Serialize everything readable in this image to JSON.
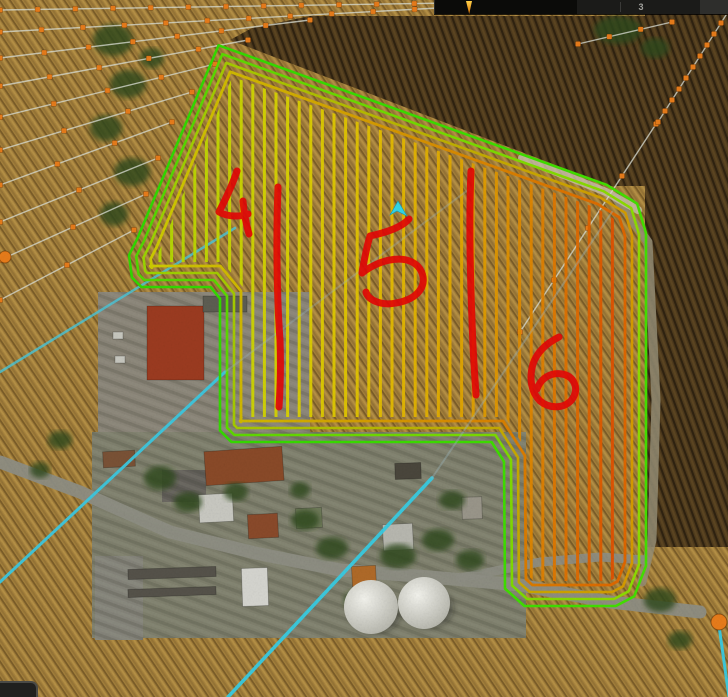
{
  "hud": {
    "count_label": "3"
  },
  "map": {
    "colors": {
      "stubble": "#a5813c",
      "stubble_dark": "#5e4a22",
      "stubble_light": "#c8a055",
      "plow": "#4e3a1c",
      "plow_dark": "#2e2210",
      "village": "#7f806d",
      "yard": "#8a8578",
      "road": "#8e8e84",
      "gravel": "#958e76",
      "gravel_light": "#c9c2ae",
      "waypoint": "#e87c1a",
      "ad_line": "#d9ddd3",
      "cyan": "#38cce4",
      "cyan_faint": "#9fb8c0",
      "red": "#e60505",
      "player": "#35d7e8"
    },
    "field": {
      "boundary": [
        [
          218,
          44
        ],
        [
          607,
          184
        ],
        [
          638,
          203
        ],
        [
          647,
          233
        ],
        [
          647,
          566
        ],
        [
          635,
          597
        ],
        [
          616,
          607
        ],
        [
          524,
          607
        ],
        [
          504,
          589
        ],
        [
          503,
          462
        ],
        [
          491,
          443
        ],
        [
          231,
          443
        ],
        [
          219,
          431
        ],
        [
          219,
          299
        ],
        [
          210,
          288
        ],
        [
          141,
          288
        ],
        [
          131,
          278
        ],
        [
          128,
          255
        ],
        [
          137,
          237
        ]
      ],
      "headlands": {
        "insets": [
          1,
          8,
          15,
          22
        ],
        "widths": [
          2.6,
          2.6,
          2.6,
          2.8
        ],
        "gradients": [
          [
            "#30d800",
            "#44e000"
          ],
          [
            "#50d800",
            "#90dc00"
          ],
          [
            "#98d800",
            "#d89800"
          ],
          [
            "#ccd200",
            "#e06000"
          ]
        ]
      },
      "rows": {
        "x_start": 160,
        "x_end": 643,
        "step": 11.6,
        "width": 3,
        "clip_inset": 26,
        "color_stops": [
          [
            160,
            "#b4dc00"
          ],
          [
            290,
            "#dcd400"
          ],
          [
            380,
            "#e6c000"
          ],
          [
            470,
            "#e2a400"
          ],
          [
            540,
            "#e08200"
          ],
          [
            600,
            "#e05c00"
          ],
          [
            643,
            "#e63c00"
          ]
        ]
      }
    },
    "red_marks": [
      {
        "label": "4",
        "paths": [
          "M237,171 C231,189 224,202 219,212 C228,217 240,217 248,214",
          "M243,201 C244,213 246,224 249,234"
        ]
      },
      {
        "label": "divider-4-5",
        "paths": [
          "M278,187 C276,240 277,300 280,340 C281,368 280,392 279,407"
        ]
      },
      {
        "label": "5",
        "paths": [
          "M409,219 C401,228 384,233 370,236 C366,249 364,261 362,273",
          "M362,273 C381,258 409,253 420,269 C429,284 419,299 396,303 C381,306 368,300 366,292"
        ]
      },
      {
        "label": "divider-5-6",
        "paths": [
          "M471,171 C469,215 470,270 472,320 C473,355 475,378 476,395"
        ]
      },
      {
        "label": "6",
        "paths": [
          "M559,337 C547,343 537,352 533,364 C529,378 531,392 540,401 C551,410 567,408 573,398 C579,388 574,376 562,374 C551,372 541,378 537,389"
        ]
      }
    ],
    "player_arrow": [
      [
        398,
        201
      ],
      [
        407,
        216
      ],
      [
        397,
        211
      ],
      [
        390,
        215
      ]
    ],
    "ad_lines": [
      [
        0,
        10,
        452,
        3,
        13
      ],
      [
        0,
        32,
        456,
        7,
        12
      ],
      [
        0,
        58,
        310,
        20,
        8
      ],
      [
        0,
        86,
        248,
        40,
        6
      ],
      [
        0,
        117,
        215,
        64,
        5
      ],
      [
        0,
        150,
        192,
        92,
        4
      ],
      [
        0,
        185,
        172,
        122,
        4
      ],
      [
        0,
        222,
        158,
        158,
        3
      ],
      [
        0,
        260,
        146,
        194,
        3
      ],
      [
        0,
        300,
        134,
        230,
        3
      ],
      [
        520,
        332,
        656,
        124,
        5
      ],
      [
        658,
        122,
        728,
        12,
        11
      ],
      [
        578,
        44,
        672,
        22,
        4
      ]
    ],
    "big_dots": [
      [
        719,
        622,
        8
      ],
      [
        5,
        257,
        6
      ]
    ],
    "cyan_lines": [
      {
        "pts": [
          [
            0,
            372
          ],
          [
            235,
            228
          ]
        ],
        "w": 2.5,
        "o": 0.8,
        "c": "#49c8dc",
        "over": false
      },
      {
        "pts": [
          [
            0,
            582
          ],
          [
            225,
            372
          ]
        ],
        "w": 3,
        "o": 0.95,
        "c": "#3cc8e0",
        "over": false
      },
      {
        "pts": [
          [
            225,
            372
          ],
          [
            468,
            190
          ]
        ],
        "w": 2,
        "o": 0.32,
        "c": "#9fb8c0",
        "over": true
      },
      {
        "pts": [
          [
            228,
            697
          ],
          [
            432,
            478
          ]
        ],
        "w": 3.5,
        "o": 0.95,
        "c": "#38cce4",
        "over": false
      },
      {
        "pts": [
          [
            432,
            478
          ],
          [
            612,
            212
          ]
        ],
        "w": 2,
        "o": 0.38,
        "c": "#9fb8c0",
        "over": true
      },
      {
        "pts": [
          [
            719,
            626
          ],
          [
            729,
            697
          ]
        ],
        "w": 3,
        "o": 0.95,
        "c": "#38cce4",
        "over": true
      }
    ],
    "dark_polys": [
      [
        [
          230,
          40
        ],
        [
          610,
          186
        ],
        [
          646,
          186
        ],
        [
          646,
          16
        ],
        [
          310,
          16
        ],
        [
          252,
          28
        ]
      ],
      [
        [
          645,
          14
        ],
        [
          728,
          14
        ],
        [
          728,
          547
        ],
        [
          645,
          547
        ]
      ]
    ],
    "dark_patches": [
      [
        428,
        452,
        92,
        112
      ],
      [
        300,
        438,
        200,
        16
      ]
    ],
    "ground_rects": [
      {
        "x": 98,
        "y": 292,
        "w": 212,
        "h": 160,
        "f": "#8a8578"
      },
      {
        "x": 92,
        "y": 432,
        "w": 434,
        "h": 206,
        "f": "#7f806d"
      },
      {
        "x": 95,
        "y": 556,
        "w": 48,
        "h": 84,
        "f": "#85847a"
      },
      {
        "x": 162,
        "y": 470,
        "w": 44,
        "h": 32,
        "f": "#63605a"
      }
    ],
    "roads": [
      {
        "pts": [
          [
            0,
            462
          ],
          [
            80,
            492
          ],
          [
            170,
            532
          ],
          [
            255,
            553
          ],
          [
            340,
            570
          ],
          [
            430,
            577
          ],
          [
            520,
            585
          ],
          [
            610,
            602
          ],
          [
            700,
            612
          ]
        ],
        "w": 13,
        "c": "#8e8e84",
        "o": 0.95
      },
      {
        "pts": [
          [
            460,
            578
          ],
          [
            540,
            562
          ],
          [
            600,
            557
          ],
          [
            646,
            560
          ]
        ],
        "w": 9,
        "c": "#8e8e84",
        "o": 0.9
      },
      {
        "pts": [
          [
            616,
            198
          ],
          [
            648,
            242
          ],
          [
            656,
            400
          ],
          [
            652,
            540
          ],
          [
            642,
            582
          ]
        ],
        "w": 9,
        "c": "#958e76",
        "o": 0.85
      },
      {
        "pts": [
          [
            522,
            158
          ],
          [
            606,
            192
          ],
          [
            638,
            210
          ]
        ],
        "w": 8,
        "c": "#c9c2ae",
        "o": 0.8
      }
    ],
    "buildings": [
      {
        "x": 147,
        "y": 306,
        "w": 57,
        "h": 74,
        "f": "#9c3b20",
        "r": 0
      },
      {
        "x": 203,
        "y": 296,
        "w": 44,
        "h": 16,
        "f": "#5d5d52",
        "r": 0
      },
      {
        "x": 205,
        "y": 449,
        "w": 78,
        "h": 34,
        "f": "#8a4a28",
        "r": -4
      },
      {
        "x": 103,
        "y": 451,
        "w": 32,
        "h": 16,
        "f": "#7a5236",
        "r": -3
      },
      {
        "x": 248,
        "y": 514,
        "w": 30,
        "h": 24,
        "f": "#8a4a2a",
        "r": -3
      },
      {
        "x": 199,
        "y": 494,
        "w": 34,
        "h": 28,
        "f": "#c9c9c2",
        "r": -3
      },
      {
        "x": 242,
        "y": 568,
        "w": 26,
        "h": 38,
        "f": "#d6d6d0",
        "r": -2
      },
      {
        "x": 383,
        "y": 524,
        "w": 30,
        "h": 26,
        "f": "#b8b8b0",
        "r": -3
      },
      {
        "x": 352,
        "y": 566,
        "w": 24,
        "h": 20,
        "f": "#b06a28",
        "r": -3
      },
      {
        "x": 296,
        "y": 508,
        "w": 26,
        "h": 20,
        "f": "#6f7a5a",
        "r": -3
      },
      {
        "x": 395,
        "y": 463,
        "w": 26,
        "h": 16,
        "f": "#4a463c",
        "r": -2
      },
      {
        "x": 462,
        "y": 497,
        "w": 20,
        "h": 22,
        "f": "#9a968a",
        "r": -2
      },
      {
        "x": 128,
        "y": 568,
        "w": 88,
        "h": 10,
        "f": "#55524a",
        "r": -2
      },
      {
        "x": 128,
        "y": 588,
        "w": 88,
        "h": 8,
        "f": "#55524a",
        "r": -2
      },
      {
        "x": 113,
        "y": 332,
        "w": 10,
        "h": 7,
        "f": "#c8c8c0",
        "r": 0
      },
      {
        "x": 115,
        "y": 356,
        "w": 10,
        "h": 7,
        "f": "#c8c8c0",
        "r": 0
      }
    ],
    "trees": [
      [
        113,
        40,
        20,
        16
      ],
      [
        128,
        84,
        18,
        14
      ],
      [
        106,
        128,
        16,
        13
      ],
      [
        132,
        172,
        18,
        14
      ],
      [
        114,
        214,
        14,
        12
      ],
      [
        152,
        58,
        12,
        10
      ],
      [
        618,
        30,
        24,
        14
      ],
      [
        655,
        48,
        14,
        10
      ],
      [
        160,
        478,
        16,
        12
      ],
      [
        188,
        502,
        14,
        10
      ],
      [
        236,
        492,
        12,
        9
      ],
      [
        305,
        520,
        14,
        10
      ],
      [
        332,
        548,
        16,
        11
      ],
      [
        398,
        556,
        18,
        12
      ],
      [
        438,
        540,
        16,
        11
      ],
      [
        452,
        500,
        13,
        9
      ],
      [
        470,
        560,
        14,
        10
      ],
      [
        360,
        600,
        16,
        10
      ],
      [
        432,
        600,
        14,
        9
      ],
      [
        300,
        490,
        10,
        8
      ],
      [
        660,
        600,
        16,
        12
      ],
      [
        680,
        640,
        12,
        9
      ],
      [
        60,
        440,
        12,
        9
      ],
      [
        40,
        470,
        10,
        8
      ]
    ],
    "silos": [
      [
        371,
        607,
        27
      ],
      [
        424,
        603,
        26
      ]
    ]
  }
}
